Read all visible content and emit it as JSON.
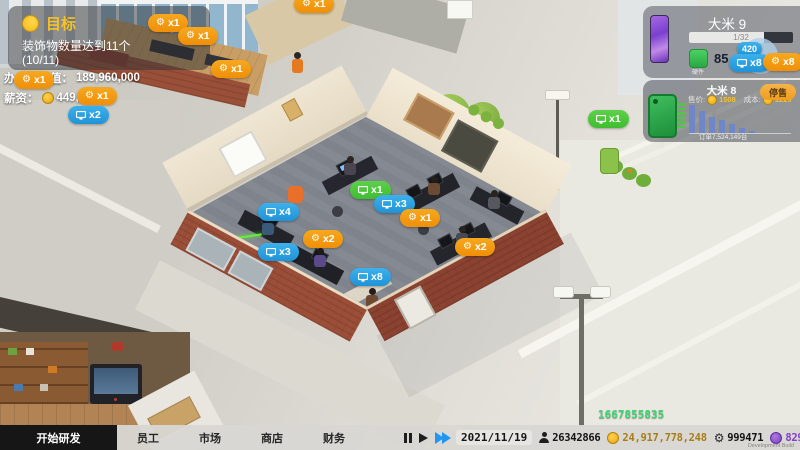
{
  "goal_panel": {
    "title": "目标",
    "line1": "装饰物数量达到11个",
    "line2": "(10/11)"
  },
  "info_lines": {
    "office_value_label": "办公室价值：",
    "office_value": "189,960,000",
    "salary_label": "薪资：",
    "salary": "449,221"
  },
  "product_panel": {
    "title": "大米 9",
    "progress_text": "1/32",
    "progress_percent": 72,
    "hardware_label": "硬件",
    "hardware_value": "85",
    "badge_420": "420"
  },
  "prev_product": {
    "title": "大米 8",
    "price_label": "售价:",
    "price": "1508",
    "cost_label": "成本:",
    "cost": "1229",
    "button_label": "停售",
    "orders_label": "订单7,524,149台"
  },
  "chart_data": {
    "type": "bar",
    "title": "大米 8 订单走势",
    "values": [
      38,
      30,
      22,
      17,
      12,
      7,
      3
    ],
    "x_axis_label": "订单7,524,149台",
    "bar_color": "#6f87c9",
    "ylim": [
      0,
      40
    ],
    "grid": false
  },
  "bubbles": [
    {
      "type": "orange",
      "icon": "wrench",
      "label": "x1",
      "x": 148,
      "y": 14
    },
    {
      "type": "orange",
      "icon": "wrench",
      "label": "x1",
      "x": 178,
      "y": 27
    },
    {
      "type": "orange",
      "icon": "wrench",
      "label": "x1",
      "x": 294,
      "y": -5
    },
    {
      "type": "orange",
      "icon": "wrench",
      "label": "x1",
      "x": 211,
      "y": 60
    },
    {
      "type": "orange",
      "icon": "wrench",
      "label": "x1",
      "x": 14,
      "y": 71
    },
    {
      "type": "orange",
      "icon": "wrench",
      "label": "x1",
      "x": 77,
      "y": 87
    },
    {
      "type": "blue",
      "icon": "monitor",
      "label": "x2",
      "x": 68,
      "y": 106
    },
    {
      "type": "green",
      "icon": "monitor",
      "label": "x1",
      "x": 588,
      "y": 110
    },
    {
      "type": "green",
      "icon": "monitor",
      "label": "x1",
      "x": 350,
      "y": 181
    },
    {
      "type": "blue",
      "icon": "monitor",
      "label": "x3",
      "x": 374,
      "y": 195
    },
    {
      "type": "blue",
      "icon": "monitor",
      "label": "x4",
      "x": 258,
      "y": 203
    },
    {
      "type": "orange",
      "icon": "wrench",
      "label": "x1",
      "x": 400,
      "y": 209
    },
    {
      "type": "orange",
      "icon": "wrench",
      "label": "x2",
      "x": 303,
      "y": 230
    },
    {
      "type": "blue",
      "icon": "monitor",
      "label": "x3",
      "x": 258,
      "y": 243
    },
    {
      "type": "orange",
      "icon": "wrench",
      "label": "x2",
      "x": 455,
      "y": 238
    },
    {
      "type": "blue",
      "icon": "monitor",
      "label": "x8",
      "x": 350,
      "y": 268
    },
    {
      "type": "blue",
      "icon": "none",
      "label": "420",
      "x": 737,
      "y": 42,
      "small": true
    },
    {
      "type": "blue",
      "icon": "monitor",
      "label": "x8",
      "x": 729,
      "y": 54
    },
    {
      "type": "orange",
      "icon": "wrench",
      "label": "x8",
      "x": 763,
      "y": 53
    }
  ],
  "floating_income": "1667855835",
  "bottom_bar": {
    "research_tab": "开始研发",
    "tabs": [
      "员工",
      "市场",
      "商店",
      "财务"
    ],
    "date": "2021/11/19",
    "population": "26342866",
    "money": "24,917,778,248",
    "parts": "999471",
    "premium": "829954",
    "watermark": "Development Build"
  },
  "colors": {
    "bubble_orange": "#f39c12",
    "bubble_blue": "#29a3e3",
    "bubble_green": "#4fc93d",
    "money_gold": "#a87d15",
    "premium_purple": "#8040c8",
    "income_green": "#3fd673"
  }
}
